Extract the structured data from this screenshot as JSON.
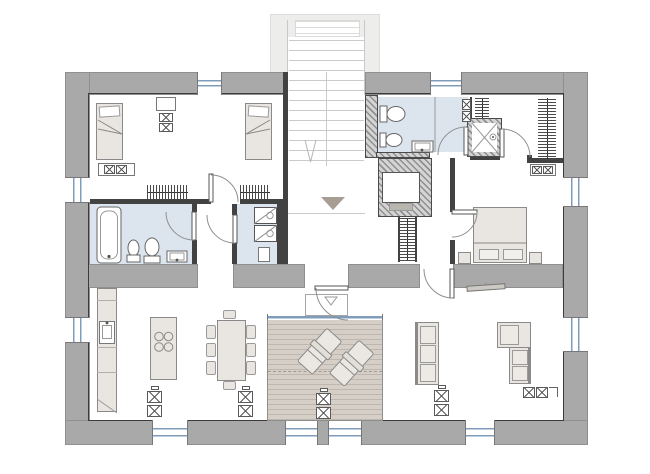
{
  "plan": {
    "type": "architectural-floor-plan",
    "description": "single-storey house plan with central entry stair, two bedrooms, two bathrooms, laundry, walk-in closet, fireplace, open kitchen-dining-living space and recessed timber terrace",
    "palette": {
      "wall": "#a9a9a9",
      "wall_edge": "#8f8f8f",
      "partition": "#424242",
      "inner_outline": "#3c3c3c",
      "porch": "#ededec",
      "stair_line": "#cbcbcb",
      "bath_floor": "#dce5ed",
      "deck": "#d6cfc7",
      "deck_plank": "#bfb7ad",
      "furniture_fill": "#e9e6e1",
      "furniture_edge": "#8a8a8a",
      "cushion": "#edeae6",
      "fixture_edge": "#666666",
      "glazing": "#7f9cba",
      "entry_marker": "#a89d93",
      "hatch_a": "#8f8f8f",
      "hatch_b": "#d4d4d4"
    },
    "rooms": [
      {
        "name": "kids-bedroom",
        "position": "top-left",
        "furniture": [
          "single-bed",
          "single-bed",
          "nightstand-with-lamps",
          "dresser",
          "wardrobe",
          "wardrobe"
        ]
      },
      {
        "name": "family-bathroom",
        "position": "mid-left",
        "fixtures": [
          "bathtub",
          "bidet",
          "toilet",
          "washbasin"
        ]
      },
      {
        "name": "laundry",
        "position": "mid-center",
        "fixtures": [
          "washing-machine",
          "dryer",
          "service-hatch"
        ]
      },
      {
        "name": "entry-hall",
        "position": "center",
        "features": [
          "exterior-stair",
          "down-arrow",
          "entry-direction-triangle",
          "doormat",
          "coat-rail"
        ]
      },
      {
        "name": "master-bathroom",
        "position": "top-center-right",
        "fixtures": [
          "toilet",
          "bidet",
          "washbasin",
          "glass-partition",
          "shelf-unit"
        ]
      },
      {
        "name": "shower-room",
        "position": "top-right-center",
        "fixtures": [
          "shower-tray"
        ]
      },
      {
        "name": "walk-in-closet",
        "position": "top-right",
        "fixtures": [
          "clothes-rail",
          "clothes-rail",
          "cabinet"
        ]
      },
      {
        "name": "master-bedroom",
        "position": "right",
        "furniture": [
          "double-bed",
          "nightstand",
          "nightstand"
        ]
      },
      {
        "name": "kitchen",
        "position": "bottom-left",
        "furniture": [
          "wall-counter",
          "kitchen-sink",
          "island-with-cooktop"
        ]
      },
      {
        "name": "dining-area",
        "position": "bottom-left-center",
        "furniture": [
          "dining-table",
          "eight-chairs"
        ]
      },
      {
        "name": "living-room",
        "position": "bottom-right",
        "furniture": [
          "three-seat-sofa",
          "corner-sofa",
          "wall-tv",
          "side-stands"
        ]
      },
      {
        "name": "terrace",
        "position": "bottom-center",
        "furniture": [
          "timber-deck",
          "sun-lounger",
          "sun-lounger",
          "plant-stand",
          "sliding-glass-wall"
        ]
      },
      {
        "name": "fireplace",
        "position": "center",
        "fixtures": [
          "firebox",
          "hearth"
        ]
      }
    ],
    "counts": {
      "windows": 10,
      "glass_doors": 2,
      "interior_doors": 8,
      "cooktop_burners": 4,
      "dining_chairs": 8,
      "sun_loungers": 2
    },
    "icons": [
      "stair-down-arrow-icon",
      "entry-triangle-icon",
      "washer-drum-icon",
      "shower-cross-icon",
      "cooktop-burner-icon"
    ]
  }
}
